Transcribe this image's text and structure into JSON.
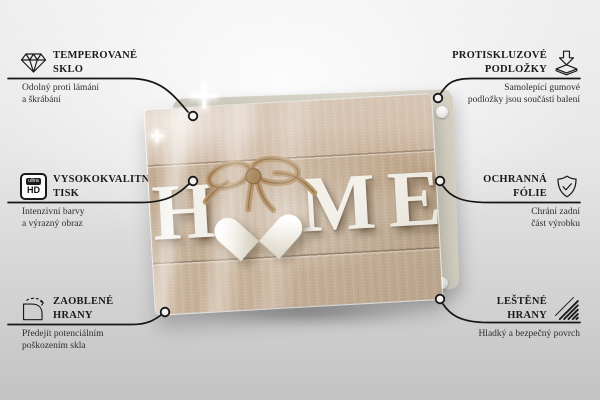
{
  "colors": {
    "callout_line": "#161616",
    "title_text": "#1b1b1b",
    "desc_text": "#2e2e2e",
    "wood_tan": "#c1aa90",
    "letter_white": "#f3f0e9",
    "backing_panel": "#d5d2c4",
    "twine": "#b8956a",
    "background_top": "#efefef",
    "background_bottom": "#c3c3c3"
  },
  "features": {
    "top_left": {
      "icon": "diamond-icon",
      "title1": "TEMPEROVANÉ",
      "title2": "SKLO",
      "desc1": "Odolný proti lámání",
      "desc2": "a škrábání"
    },
    "mid_left": {
      "icon": "ultra-hd-icon",
      "icon_top_label": "ultra",
      "icon_label": "HD",
      "title1": "VYSOKOKVALITNÍ",
      "title2": "TISK",
      "desc1": "Intenzivní barvy",
      "desc2": "a výrazný obraz"
    },
    "bottom_left": {
      "icon": "rounded-corner-icon",
      "title1": "ZAOBLENÉ",
      "title2": "HRANY",
      "desc1": "Předejít potenciálním",
      "desc2": "poškozením skla"
    },
    "top_right": {
      "icon": "anti-slip-pads-icon",
      "title1": "PROTISKLUZOVÉ",
      "title2": "PODLOŽKY",
      "desc1": "Samolepící gumové",
      "desc2": "podložky jsou součástí balení"
    },
    "mid_right": {
      "icon": "shield-check-icon",
      "title1": "OCHRANNÁ",
      "title2": "FÓLIE",
      "desc1": "Chrání zadní",
      "desc2": "část výrobku"
    },
    "bottom_right": {
      "icon": "polished-edges-icon",
      "title1": "LEŠTĚNÉ",
      "title2": "HRANY",
      "desc1": "Hladký a bezpečný povrch",
      "desc2": ""
    }
  },
  "product": {
    "word": "HOME",
    "letters": [
      "H",
      "M",
      "E"
    ]
  }
}
